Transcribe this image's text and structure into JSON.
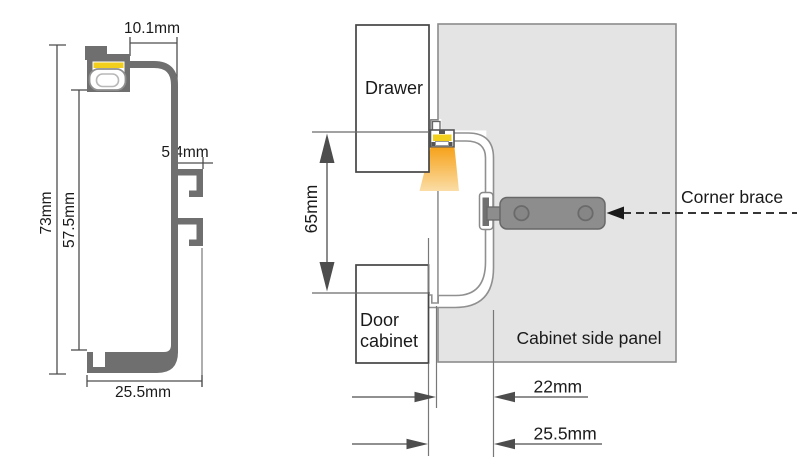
{
  "colors": {
    "profile_metal": "#6f6f6f",
    "led_strip": "#f2cf1d",
    "light_top": "#f6a21b",
    "light_bottom": "#fbdda6",
    "panel_fill": "#e4e4e4",
    "panel_border": "#8c8c8c",
    "brace_fill": "#8d8d8d",
    "outline_gray": "#909090"
  },
  "left_profile": {
    "width_top": "10.1mm",
    "clip_depth": "5.4mm",
    "height_total": "73mm",
    "height_inner": "57.5mm",
    "width_bottom": "25.5mm"
  },
  "installation": {
    "drawer": "Drawer",
    "door_line1": "Door",
    "door_line2": "cabinet",
    "side_panel": "Cabinet side panel",
    "corner_brace": "Corner brace",
    "mount_height": "65mm",
    "offset_inner": "22mm",
    "offset_outer": "25.5mm"
  }
}
